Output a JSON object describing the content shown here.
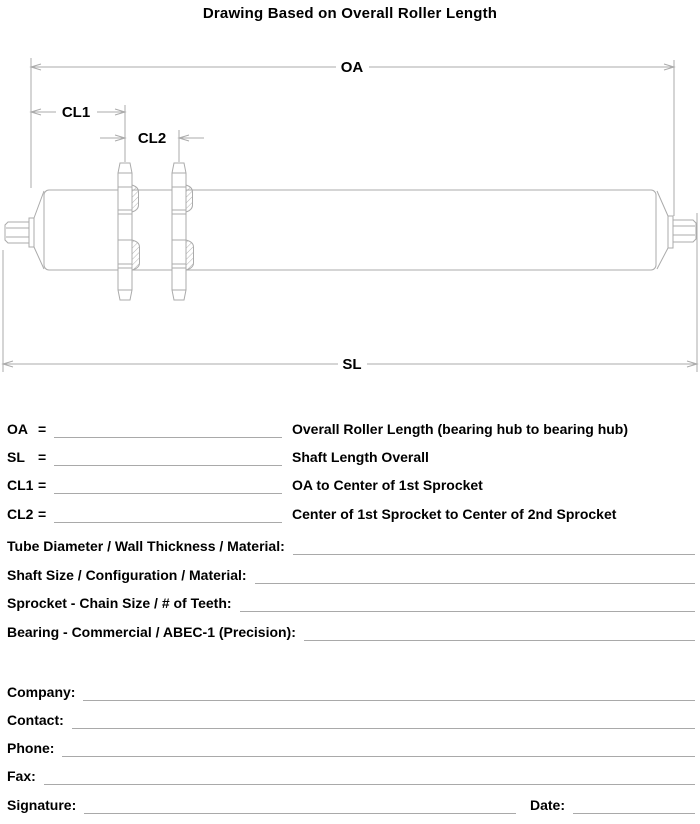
{
  "title": "Drawing Based on Overall Roller Length",
  "diagram": {
    "oa_label": "OA",
    "cl1_label": "CL1",
    "cl2_label": "CL2",
    "sl_label": "SL",
    "line_color": "#ababab"
  },
  "dimension_rows": [
    {
      "label": "OA",
      "eq": "=",
      "value": "",
      "desc": "Overall Roller Length (bearing hub to bearing hub)"
    },
    {
      "label": "SL",
      "eq": "=",
      "value": "",
      "desc": "Shaft Length Overall"
    },
    {
      "label": "CL1",
      "eq": "=",
      "value": "",
      "desc": "OA to Center of 1st Sprocket"
    },
    {
      "label": "CL2",
      "eq": "=",
      "value": "",
      "desc": "Center of 1st Sprocket to Center of 2nd Sprocket"
    }
  ],
  "spec_rows": [
    {
      "label": "Tube Diameter / Wall Thickness / Material:",
      "value": ""
    },
    {
      "label": "Shaft Size / Configuration / Material:",
      "value": ""
    },
    {
      "label": "Sprocket - Chain Size / # of Teeth:",
      "value": ""
    },
    {
      "label": "Bearing - Commercial / ABEC-1 (Precision):",
      "value": ""
    }
  ],
  "contact_rows": [
    {
      "label": "Company:",
      "value": ""
    },
    {
      "label": "Contact:",
      "value": ""
    },
    {
      "label": "Phone:",
      "value": ""
    },
    {
      "label": "Fax:",
      "value": ""
    }
  ],
  "signature_row": {
    "signature_label": "Signature:",
    "signature_value": "",
    "date_label": "Date:",
    "date_value": ""
  }
}
